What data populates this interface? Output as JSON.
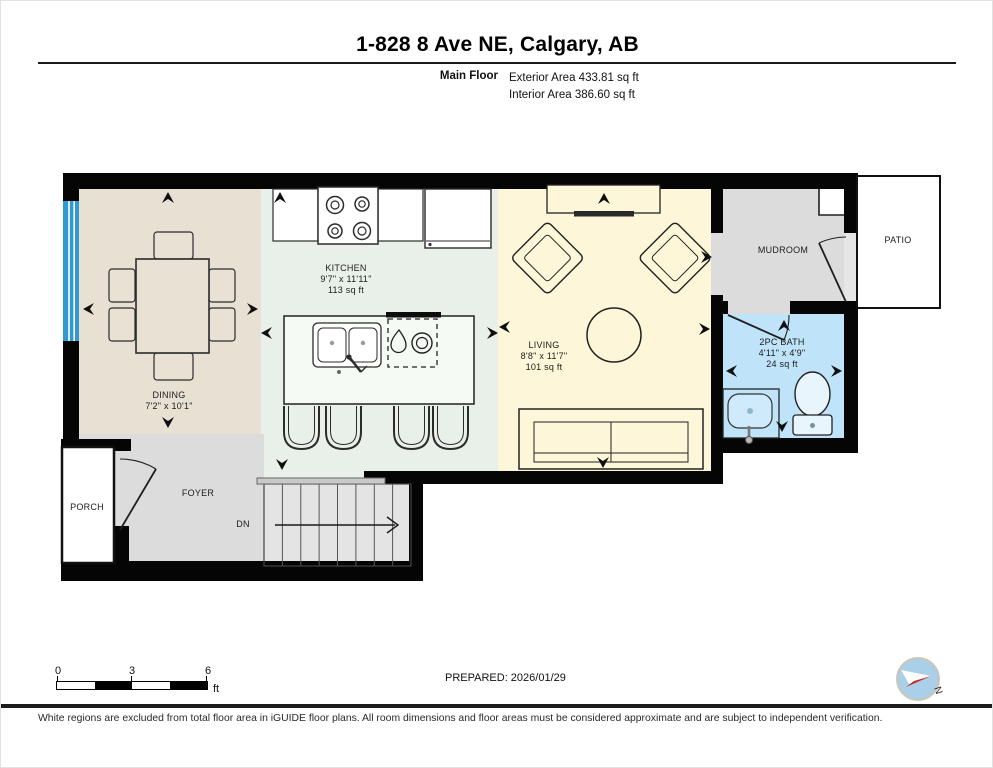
{
  "header": {
    "title": "1-828 8 Ave NE, Calgary, AB",
    "floor_label": "Main Floor",
    "exterior_area": "Exterior Area 433.81 sq ft",
    "interior_area": "Interior Area 386.60 sq ft"
  },
  "rooms": {
    "dining": {
      "name": "DINING",
      "dims": "7'2\" x 10'1\""
    },
    "kitchen": {
      "name": "KITCHEN",
      "dims": "9'7\" x 11'11\"",
      "area": "113 sq ft"
    },
    "living": {
      "name": "LIVING",
      "dims": "8'8\" x 11'7\"",
      "area": "101 sq ft"
    },
    "bath": {
      "name": "2PC BATH",
      "dims": "4'11\" x 4'9\"",
      "area": "24 sq ft"
    },
    "mudroom": {
      "name": "MUDROOM"
    },
    "patio": {
      "name": "PATIO"
    },
    "porch": {
      "name": "PORCH"
    },
    "foyer": {
      "name": "FOYER"
    },
    "stairs": {
      "dn": "DN"
    }
  },
  "footer": {
    "scale": {
      "t0": "0",
      "t3": "3",
      "t6": "6",
      "unit": "ft"
    },
    "prepared": "PREPARED: 2026/01/29",
    "compass_n": "N",
    "disclaimer": "White regions are excluded from total floor area in iGUIDE floor plans. All room dimensions and floor areas must be considered approximate and are subject to independent verification."
  },
  "colors": {
    "wall": "#050505",
    "dining_floor": "#e8e0d2",
    "kitchen_floor": "#e9f0e9",
    "living_floor": "#fdf6d8",
    "gray_floor": "#dcdcdc",
    "stairs_floor": "#e4e4e4",
    "bath_floor": "#bfe3f8",
    "window_blue": "#2f9ad0",
    "compass_fill": "#a9cfe9",
    "compass_red": "#cc2222"
  }
}
